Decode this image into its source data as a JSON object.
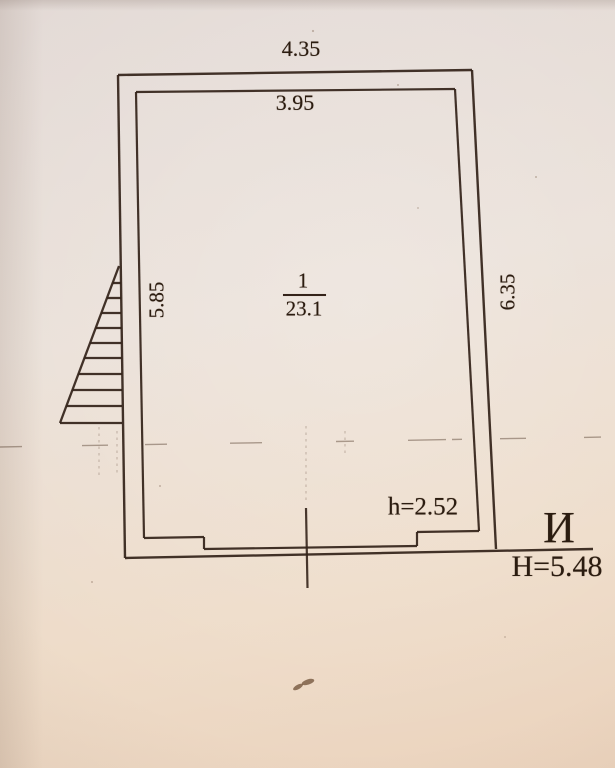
{
  "plan": {
    "dimensions": {
      "top_outer": "4.35",
      "top_inner": "3.95",
      "left": "5.85",
      "right": "6.35"
    },
    "room": {
      "number": "1",
      "area": "23.1"
    },
    "annotations": {
      "interior_height": "h=2.52",
      "letter": "И",
      "overall_height": "Н=5.48"
    },
    "symbols": {
      "stairs": "stair-hatch-triangle",
      "boundary": "dashed-boundary-line",
      "survey_tick": "vertical-tick-mark"
    },
    "colors": {
      "ink": "#34231a",
      "pencil": "#7a6656",
      "paper_top": "#e3dad6",
      "paper_bottom": "#ebd3bd"
    }
  }
}
